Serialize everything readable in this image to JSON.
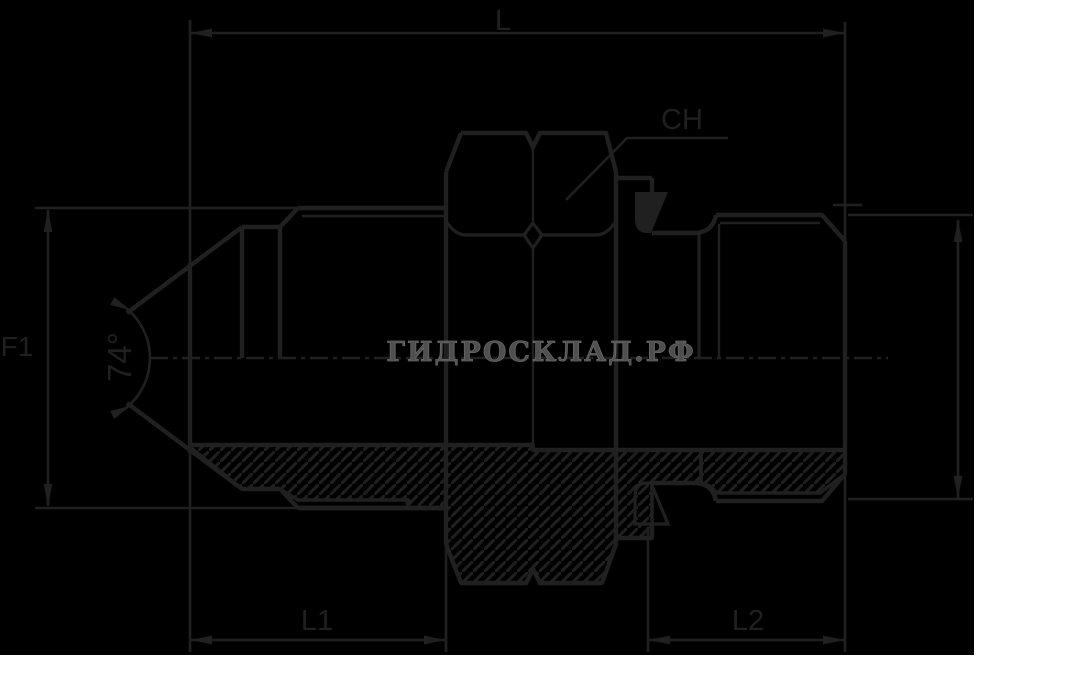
{
  "canvas": {
    "background": "#000000",
    "margin_color": "#ffffff",
    "line_color": "#202020",
    "black_area": {
      "width": 974,
      "height": 655
    }
  },
  "watermark": {
    "text": "ГИДРОСКЛАД.РФ",
    "color": "#545454"
  },
  "dimension_labels": {
    "overall_length": "L",
    "hex_wrench_size": "CH",
    "flare_thread_diameter": "F1",
    "cone_angle": "74°",
    "left_section_length": "L1",
    "right_thread_length": "L2"
  },
  "drawing": {
    "type": "engineering half-section drawing",
    "subject": "hydraulic adapter fitting: male 74° flare (JIC) end, center hex (CH), male threaded end with bonded seal washer",
    "view_notes": "top half external view, bottom half hatched axial section, dash-dot centerline"
  }
}
